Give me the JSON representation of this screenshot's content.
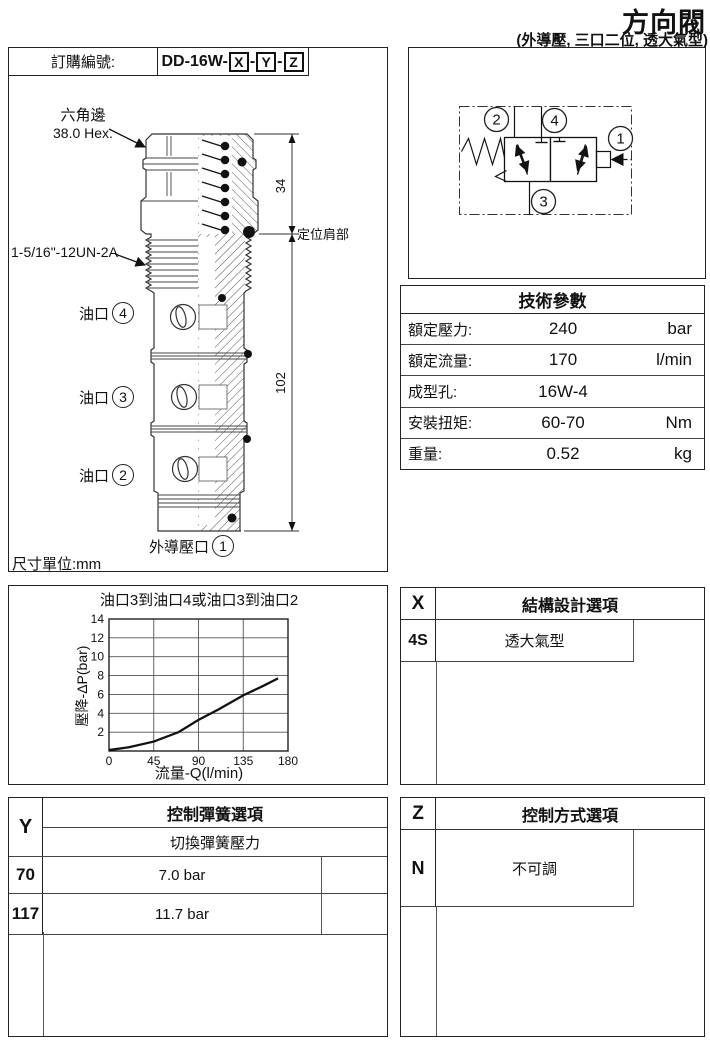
{
  "page": {
    "title": "方向閥",
    "subtitle": "(外導壓, 三口二位, 透大氣型)"
  },
  "order": {
    "label": "訂購編號:",
    "prefix": "DD-16W-",
    "sep": "-",
    "codes": [
      "X",
      "Y",
      "Z"
    ]
  },
  "drawing": {
    "hex_label_cn": "六角邊",
    "hex_label": "38.0 Hex.",
    "thread_label": "1-5/16\"-12UN-2A",
    "port_label": "油口",
    "ports": [
      "4",
      "3",
      "2"
    ],
    "pilot_label": "外導壓口",
    "pilot_port": "1",
    "dim_top": "34",
    "dim_bottom": "102",
    "shoulder_label": "定位肩部",
    "units_label": "尺寸單位:mm"
  },
  "schematic": {
    "ports": {
      "p1": "1",
      "p2": "2",
      "p3": "3",
      "p4": "4"
    }
  },
  "tech_table": {
    "title": "技術參數",
    "rows": [
      {
        "label": "額定壓力:",
        "value": "240",
        "unit": "bar"
      },
      {
        "label": "額定流量:",
        "value": "170",
        "unit": "l/min"
      },
      {
        "label": "成型孔:",
        "value": "16W-4",
        "unit": ""
      },
      {
        "label": "安裝扭矩:",
        "value": "60-70",
        "unit": "Nm"
      },
      {
        "label": "重量:",
        "value": "0.52",
        "unit": "kg"
      }
    ]
  },
  "chart_data": {
    "type": "line",
    "title": "油口3到油口4或油口3到油口2",
    "xlabel": "流量-Q(l/min)",
    "ylabel": "壓降-ΔP(bar)",
    "xlim": [
      0,
      180
    ],
    "ylim": [
      0,
      14
    ],
    "xticks": [
      0,
      45,
      90,
      135,
      180
    ],
    "yticks": [
      2,
      4,
      6,
      8,
      10,
      12,
      14
    ],
    "grid": true,
    "legend": false,
    "series": [
      {
        "name": "pressure-drop",
        "x": [
          0,
          20,
          45,
          70,
          90,
          110,
          135,
          155,
          170
        ],
        "y": [
          0.1,
          0.4,
          1.0,
          2.0,
          3.3,
          4.4,
          5.9,
          6.9,
          7.7
        ]
      }
    ]
  },
  "options_x": {
    "code": "X",
    "title": "結構設計選項",
    "rows": [
      {
        "code": "4S",
        "label": "透大氣型"
      }
    ]
  },
  "options_y": {
    "code": "Y",
    "title": "控制彈簧選項",
    "subtitle": "切換彈簧壓力",
    "rows": [
      {
        "code": "70",
        "label": "7.0 bar"
      },
      {
        "code": "117",
        "label": "11.7 bar"
      }
    ]
  },
  "options_z": {
    "code": "Z",
    "title": "控制方式選項",
    "rows": [
      {
        "code": "N",
        "label": "不可調"
      }
    ]
  }
}
